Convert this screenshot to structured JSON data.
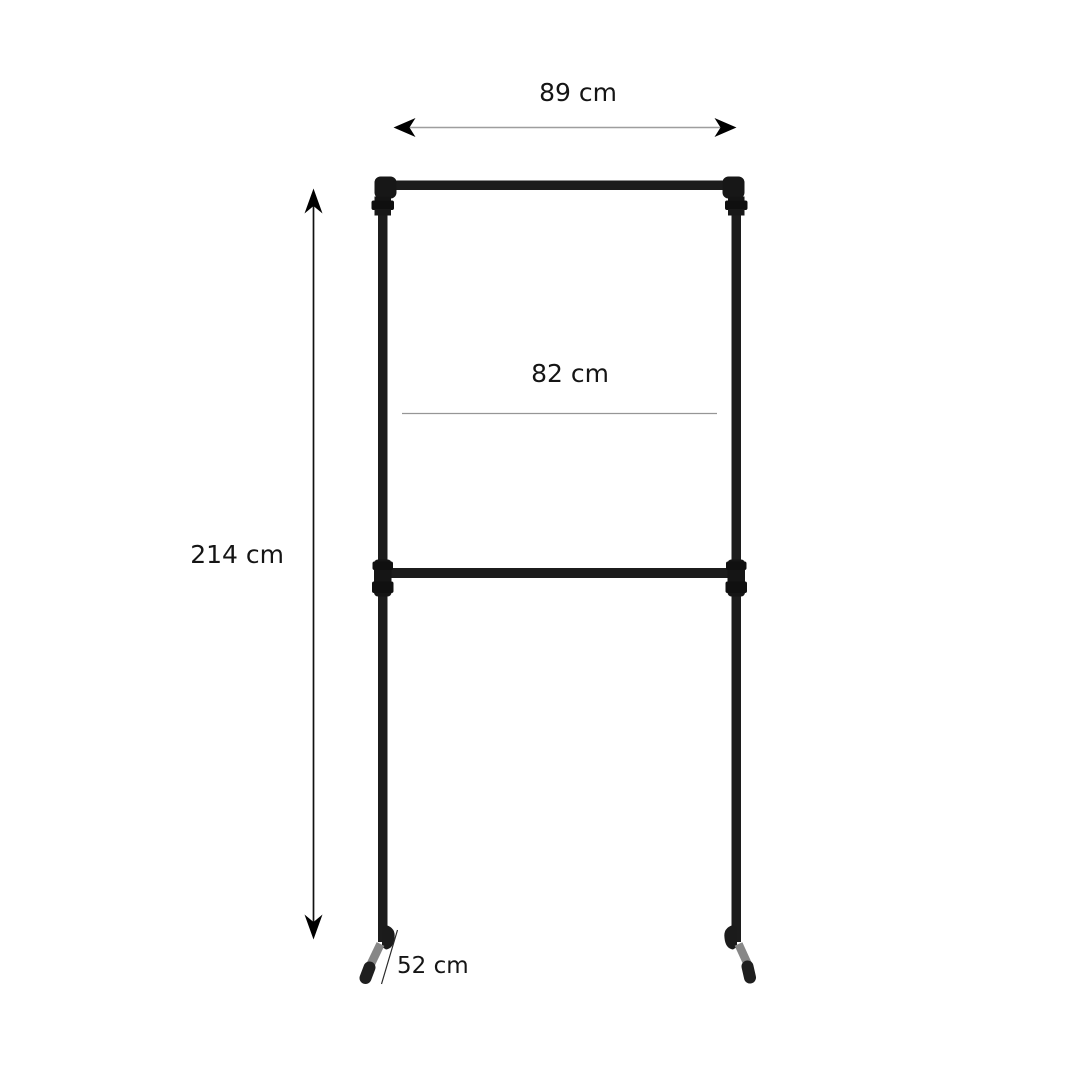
{
  "diagram": {
    "type": "product-dimension-diagram",
    "subject": "double-rail pipe clothes rack",
    "dimensions": {
      "top_width": {
        "label": "89 cm"
      },
      "inner_width": {
        "label": "82 cm"
      },
      "height": {
        "label": "214 cm"
      },
      "depth": {
        "label": "52 cm"
      }
    },
    "colors": {
      "background": "#ffffff",
      "pipe": "#1c1c1c",
      "fitting": "#121212",
      "foot_tube": "#878787",
      "foot_cap": "#1f1f1f",
      "dimension_line_gray": "#9e9e9e",
      "dimension_line_black": "#111111",
      "text": "#151515"
    }
  }
}
